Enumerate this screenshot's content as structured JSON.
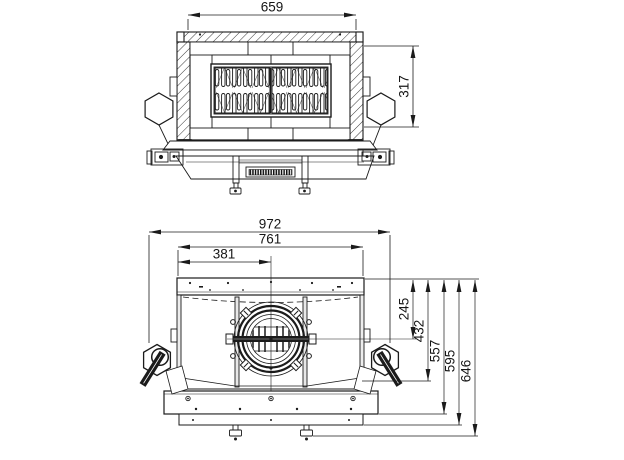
{
  "page": {
    "background": "#ffffff",
    "line_color": "#1b1b1b"
  },
  "drawing": {
    "kind": "fireplace-insert-dimension-drawing"
  },
  "front_view": {
    "width_mm": "659",
    "height_mm": "317"
  },
  "plan_view": {
    "overall_width_mm": "972",
    "inner_width_mm": "761",
    "flue_center_offset_mm": "381",
    "depths_mm": [
      "245",
      "432",
      "557",
      "595",
      "646"
    ]
  }
}
